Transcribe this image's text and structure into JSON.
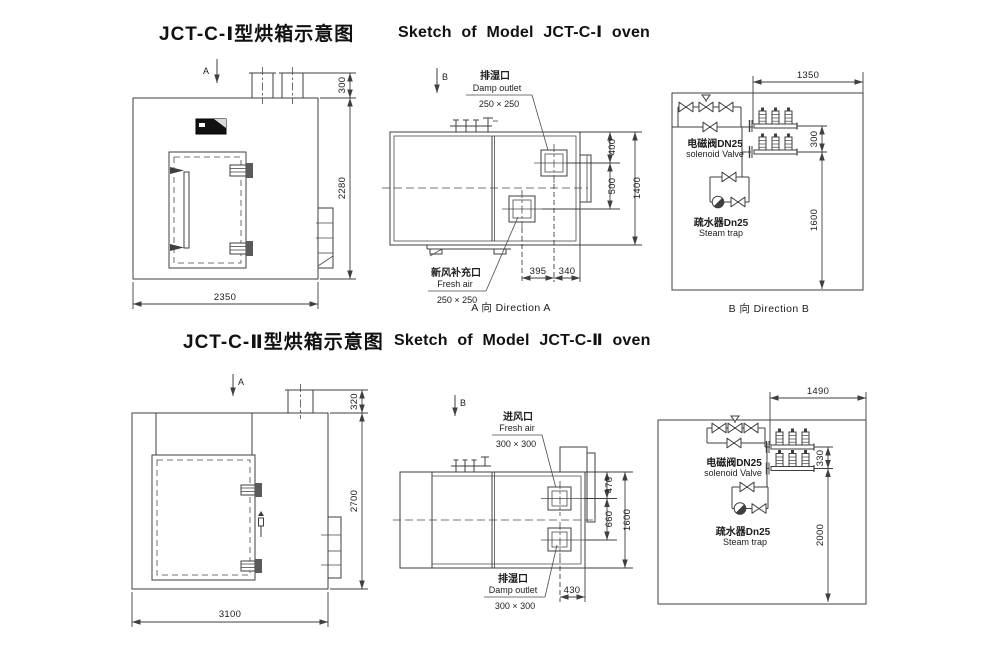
{
  "titles": {
    "s1_cn": "JCT-C-Ⅰ型烘箱示意图",
    "s1_en": "Sketch of Model JCT-C-Ⅰ oven",
    "s2_cn": "JCT-C-Ⅱ型烘箱示意图",
    "s2_en": "Sketch of Model JCT-C-Ⅱ oven"
  },
  "colors": {
    "line": "#3f3f3f",
    "text": "#1c1c1c",
    "panel": "#111111"
  },
  "front1": {
    "view_arrow": "A",
    "dim_top": "300",
    "dim_height": "2280",
    "dim_width": "2350"
  },
  "side1": {
    "view_arrow": "B",
    "damp_cn": "排湿口",
    "damp_en": "Damp outlet",
    "damp_size": "250 × 250",
    "fresh_cn": "新风补充口",
    "fresh_en": "Fresh air",
    "fresh_size": "250 × 250",
    "dim_a": "400",
    "dim_b": "500",
    "dim_h": "1400",
    "dim_c": "395",
    "dim_d": "340",
    "caption": "A 向 Direction A"
  },
  "pipe1": {
    "dim_width": "1350",
    "dim_gap": "300",
    "dim_drop": "1600",
    "valve_cn": "电磁阀DN25",
    "valve_en": "solenoid Valve",
    "trap_cn": "疏水器Dn25",
    "trap_en": "Steam trap",
    "caption": "B 向 Direction B"
  },
  "front2": {
    "view_arrow": "A",
    "dim_top": "320",
    "dim_height": "2700",
    "dim_width": "3100"
  },
  "side2": {
    "view_arrow": "B",
    "fresh_cn": "进风口",
    "fresh_en": "Fresh air",
    "fresh_size": "300 × 300",
    "damp_cn": "排湿口",
    "damp_en": "Damp outlet",
    "damp_size": "300 × 300",
    "dim_a": "470",
    "dim_b": "660",
    "dim_h": "1600",
    "dim_c": "430"
  },
  "pipe2": {
    "dim_width": "1490",
    "dim_gap": "330",
    "dim_drop": "2000",
    "valve_cn": "电磁阀DN25",
    "valve_en": "solenoid Valve",
    "trap_cn": "疏水器Dn25",
    "trap_en": "Steam trap"
  }
}
